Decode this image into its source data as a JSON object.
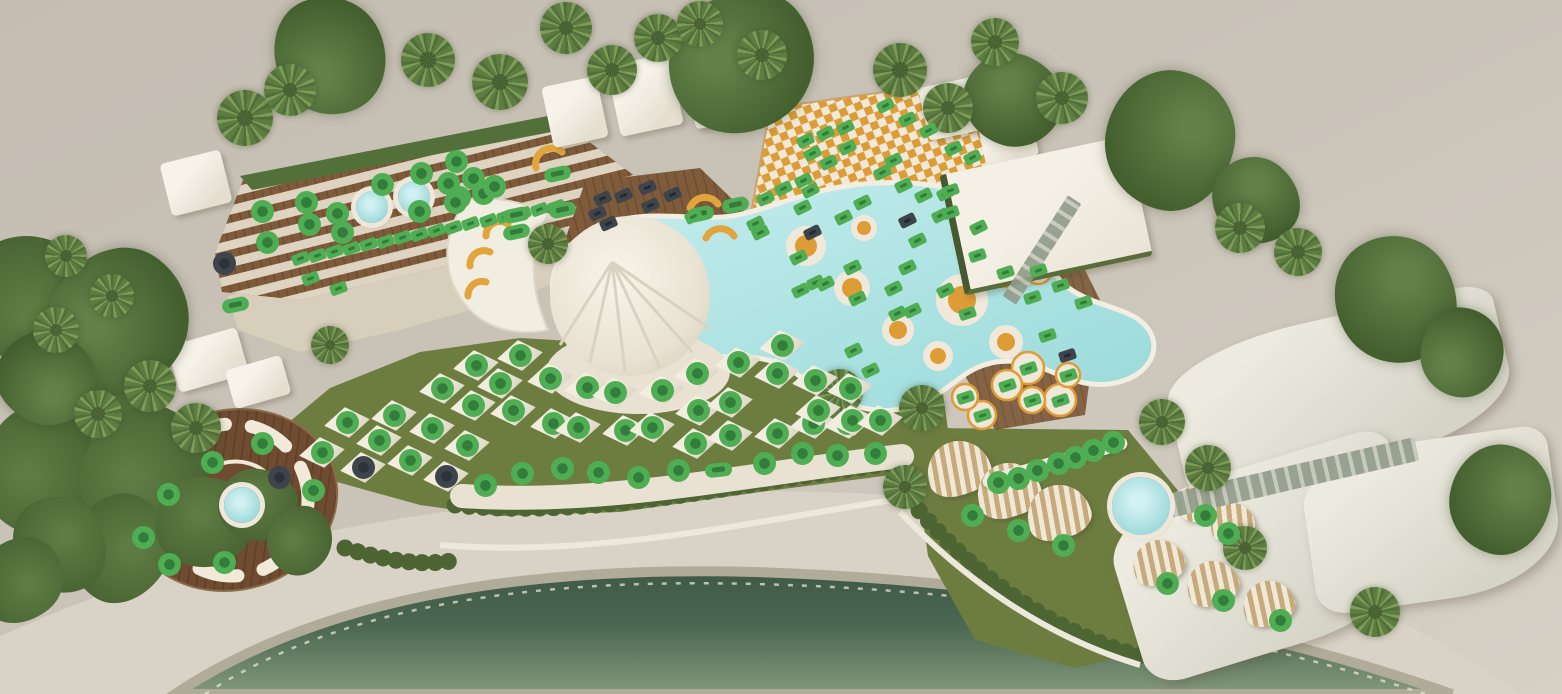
{
  "app": {
    "name": "beach-club-seating-map"
  },
  "colors": {
    "m-avail": "#4fae54",
    "m-avail-inner": "#337c3b",
    "m-occ": "#3d444b",
    "lawn": "#6d7d40",
    "pool": "#aee2e2",
    "sea": "#4c6852",
    "wood": "#7f5b3b",
    "daybed-orange": "#dd9c35",
    "structure": "#f2ede1"
  },
  "legend": {
    "available_marker": "green",
    "occupied_marker": "dark-gray"
  },
  "markers": {
    "groups": [
      {
        "id": "terrace-tables",
        "type": "circle",
        "status": "available",
        "points": [
          [
            267,
            242
          ],
          [
            262,
            211
          ],
          [
            306,
            202
          ],
          [
            337,
            213
          ],
          [
            309,
            224
          ],
          [
            342,
            232
          ],
          [
            382,
            184
          ],
          [
            421,
            173
          ],
          [
            419,
            211
          ],
          [
            456,
            161
          ],
          [
            473,
            178
          ],
          [
            448,
            183
          ],
          [
            459,
            197
          ],
          [
            483,
            193
          ],
          [
            455,
            202
          ],
          [
            494,
            186
          ]
        ]
      },
      {
        "id": "terrace-tables-occupied",
        "type": "circle",
        "status": "occupied",
        "points": [
          [
            224,
            263
          ]
        ]
      },
      {
        "id": "terrace-sunbeds",
        "type": "rect",
        "status": "available",
        "rot": -20,
        "points": [
          [
            300,
            258
          ],
          [
            317,
            255
          ],
          [
            334,
            251
          ],
          [
            351,
            248
          ],
          [
            368,
            244
          ],
          [
            385,
            241
          ],
          [
            402,
            237
          ],
          [
            419,
            234
          ],
          [
            436,
            230
          ],
          [
            453,
            227
          ],
          [
            470,
            223
          ],
          [
            488,
            220
          ],
          [
            505,
            216
          ],
          [
            522,
            213
          ],
          [
            539,
            209
          ],
          [
            556,
            206
          ],
          [
            310,
            278
          ],
          [
            338,
            288
          ]
        ]
      },
      {
        "id": "lounger-pills",
        "type": "pill",
        "status": "available",
        "rot": -12,
        "points": [
          [
            235,
            305
          ],
          [
            557,
            174
          ],
          [
            562,
            210
          ],
          [
            516,
            215
          ],
          [
            516,
            232
          ],
          [
            700,
            214
          ],
          [
            735,
            205
          ]
        ]
      },
      {
        "id": "dining-tables-occupied",
        "type": "rect",
        "status": "occupied",
        "rot": -24,
        "points": [
          [
            597,
            213
          ],
          [
            602,
            198
          ],
          [
            623,
            195
          ],
          [
            647,
            187
          ],
          [
            650,
            205
          ],
          [
            672,
            194
          ],
          [
            608,
            223
          ]
        ]
      },
      {
        "id": "pool-daybeds",
        "type": "rect",
        "status": "available",
        "rot": -26,
        "points": [
          [
            765,
            198
          ],
          [
            783,
            188
          ],
          [
            803,
            180
          ],
          [
            805,
            140
          ],
          [
            812,
            153
          ],
          [
            825,
            133
          ],
          [
            828,
            162
          ],
          [
            845,
            127
          ],
          [
            847,
            147
          ],
          [
            882,
            172
          ],
          [
            885,
            105
          ],
          [
            907,
            119
          ],
          [
            928,
            130
          ],
          [
            953,
            148
          ],
          [
            972,
            157
          ],
          [
            893,
            160
          ],
          [
            755,
            223
          ],
          [
            798,
            257
          ],
          [
            802,
            207
          ],
          [
            815,
            282
          ],
          [
            825,
            283
          ],
          [
            843,
            217
          ],
          [
            857,
            298
          ],
          [
            800,
            290
          ],
          [
            693,
            216
          ],
          [
            760,
            232
          ],
          [
            810,
            190
          ],
          [
            862,
            202
          ],
          [
            852,
            267
          ],
          [
            893,
            288
          ],
          [
            897,
            313
          ],
          [
            912,
            310
          ],
          [
            853,
            350
          ],
          [
            870,
            370
          ],
          [
            923,
            195
          ],
          [
            945,
            193
          ],
          [
            940,
            215
          ],
          [
            917,
            240
          ],
          [
            907,
            267
          ],
          [
            945,
            290
          ],
          [
            978,
            227
          ],
          [
            903,
            185
          ]
        ]
      },
      {
        "id": "pool-daybeds-occupied",
        "type": "rect",
        "status": "occupied",
        "rot": -26,
        "points": [
          [
            812,
            232
          ],
          [
            907,
            220
          ]
        ]
      },
      {
        "id": "lawn-parasols",
        "type": "circle",
        "status": "available",
        "parasol": true,
        "points": [
          [
            322,
            452
          ],
          [
            347,
            422
          ],
          [
            379,
            440
          ],
          [
            394,
            415
          ],
          [
            410,
            460
          ],
          [
            432,
            428
          ],
          [
            442,
            388
          ],
          [
            467,
            445
          ],
          [
            473,
            405
          ],
          [
            476,
            365
          ],
          [
            500,
            383
          ],
          [
            513,
            410
          ],
          [
            520,
            355
          ],
          [
            550,
            378
          ],
          [
            553,
            423
          ],
          [
            578,
            427
          ],
          [
            587,
            387
          ],
          [
            615,
            392
          ],
          [
            625,
            430
          ],
          [
            652,
            427
          ],
          [
            662,
            390
          ],
          [
            695,
            443
          ],
          [
            697,
            373
          ],
          [
            698,
            410
          ],
          [
            730,
            435
          ],
          [
            730,
            402
          ],
          [
            738,
            362
          ],
          [
            777,
            433
          ],
          [
            777,
            373
          ],
          [
            782,
            345
          ],
          [
            813,
            423
          ],
          [
            815,
            380
          ],
          [
            818,
            410
          ],
          [
            847,
            423
          ],
          [
            850,
            388
          ],
          [
            852,
            420
          ],
          [
            880,
            420
          ]
        ]
      },
      {
        "id": "lawn-parasols-occupied",
        "type": "circle",
        "status": "occupied",
        "parasol": true,
        "points": [
          [
            363,
            467
          ],
          [
            446,
            476
          ]
        ]
      },
      {
        "id": "front-row-sunbeds",
        "type": "circle",
        "status": "available",
        "points": [
          [
            485,
            485
          ],
          [
            522,
            473
          ],
          [
            562,
            468
          ],
          [
            598,
            472
          ],
          [
            638,
            477
          ],
          [
            678,
            470
          ],
          [
            764,
            463
          ],
          [
            802,
            453
          ],
          [
            837,
            455
          ],
          [
            875,
            453
          ]
        ]
      },
      {
        "id": "front-row-pill",
        "type": "pill",
        "status": "available",
        "rot": -6,
        "points": [
          [
            718,
            470
          ]
        ]
      },
      {
        "id": "restaurant-tables",
        "type": "rect",
        "status": "available",
        "rot": -18,
        "points": [
          [
            950,
            190
          ],
          [
            950,
            212
          ],
          [
            977,
            255
          ],
          [
            1005,
            272
          ],
          [
            1038,
            270
          ],
          [
            1060,
            285
          ],
          [
            1032,
            297
          ],
          [
            1083,
            302
          ],
          [
            967,
            313
          ],
          [
            1047,
            335
          ],
          [
            1068,
            375
          ],
          [
            1028,
            368
          ],
          [
            1007,
            385
          ],
          [
            1060,
            400
          ],
          [
            1032,
            400
          ],
          [
            982,
            415
          ],
          [
            965,
            397
          ]
        ]
      },
      {
        "id": "restaurant-tables-occupied",
        "type": "rect",
        "status": "occupied",
        "rot": -18,
        "points": [
          [
            1067,
            355
          ]
        ]
      },
      {
        "id": "bar-counter-seats",
        "type": "circle",
        "status": "available",
        "points": [
          [
            998,
            482
          ],
          [
            1018,
            478
          ],
          [
            1037,
            470
          ],
          [
            1058,
            463
          ],
          [
            1075,
            457
          ],
          [
            1093,
            450
          ],
          [
            1113,
            442
          ]
        ]
      },
      {
        "id": "cabana-seats",
        "type": "circle",
        "status": "available",
        "points": [
          [
            972,
            515
          ],
          [
            1018,
            530
          ],
          [
            1063,
            545
          ],
          [
            1205,
            515
          ],
          [
            1228,
            533
          ],
          [
            1167,
            583
          ],
          [
            1223,
            600
          ],
          [
            1280,
            620
          ]
        ]
      },
      {
        "id": "vip-deck-sofas",
        "type": "circle",
        "status": "available",
        "points": [
          [
            262,
            443
          ],
          [
            212,
            462
          ],
          [
            168,
            494
          ],
          [
            143,
            537
          ],
          [
            169,
            564
          ],
          [
            224,
            562
          ],
          [
            313,
            490
          ]
        ]
      },
      {
        "id": "vip-deck-sofas-occupied",
        "type": "circle",
        "status": "occupied",
        "points": [
          [
            279,
            477
          ]
        ]
      }
    ]
  },
  "scene": {
    "tents": [
      [
        196,
        183,
        62,
        54,
        -14
      ],
      [
        152,
        342,
        66,
        44,
        -16
      ],
      [
        208,
        360,
        72,
        48,
        -16
      ],
      [
        258,
        382,
        58,
        40,
        -16
      ],
      [
        575,
        112,
        56,
        62,
        -12
      ],
      [
        645,
        95,
        64,
        72,
        -12
      ],
      [
        723,
        82,
        72,
        82,
        -12
      ],
      [
        955,
        108,
        64,
        54,
        -12
      ],
      [
        1008,
        138,
        54,
        46,
        -12
      ]
    ],
    "sails": [
      [
        1340,
        392,
        340,
        150,
        -13
      ],
      [
        1268,
        556,
        300,
        185,
        -17
      ],
      [
        1432,
        520,
        250,
        160,
        -8
      ]
    ],
    "cabanas": [
      [
        958,
        468,
        64,
        54,
        -18
      ],
      [
        1008,
        490,
        64,
        54,
        -18
      ],
      [
        1058,
        512,
        64,
        54,
        -18
      ],
      [
        1200,
        502,
        44,
        38,
        -14
      ],
      [
        1232,
        522,
        44,
        38,
        -14
      ],
      [
        1158,
        562,
        52,
        44,
        -20
      ],
      [
        1212,
        583,
        52,
        44,
        -20
      ],
      [
        1268,
        603,
        52,
        44,
        -20
      ]
    ],
    "jacuzzis": [
      [
        372,
        207,
        32
      ],
      [
        414,
        197,
        32
      ],
      [
        1141,
        506,
        58
      ],
      [
        242,
        505,
        36
      ]
    ],
    "palms": [
      [
        245,
        118,
        56
      ],
      [
        290,
        90,
        52
      ],
      [
        428,
        60,
        54
      ],
      [
        500,
        82,
        56
      ],
      [
        566,
        28,
        52
      ],
      [
        612,
        70,
        50
      ],
      [
        658,
        38,
        48
      ],
      [
        700,
        24,
        46
      ],
      [
        762,
        55,
        50
      ],
      [
        900,
        70,
        54
      ],
      [
        948,
        108,
        50
      ],
      [
        995,
        42,
        48
      ],
      [
        1062,
        98,
        52
      ],
      [
        548,
        244,
        40
      ],
      [
        1240,
        228,
        50
      ],
      [
        1298,
        252,
        48
      ],
      [
        150,
        386,
        52
      ],
      [
        196,
        428,
        50
      ],
      [
        98,
        414,
        48
      ],
      [
        56,
        330,
        46
      ],
      [
        112,
        296,
        44
      ],
      [
        66,
        256,
        42
      ],
      [
        840,
        392,
        46
      ],
      [
        922,
        408,
        46
      ],
      [
        905,
        487,
        44
      ],
      [
        1162,
        422,
        46
      ],
      [
        1208,
        468,
        46
      ],
      [
        1245,
        548,
        44
      ],
      [
        1375,
        612,
        50
      ],
      [
        330,
        345,
        38
      ]
    ],
    "canopies": [
      [
        330,
        55,
        120
      ],
      [
        742,
        62,
        150
      ],
      [
        1013,
        100,
        100
      ],
      [
        1170,
        140,
        140
      ],
      [
        1256,
        200,
        90
      ],
      [
        1396,
        300,
        130
      ],
      [
        1462,
        352,
        90
      ],
      [
        118,
        322,
        150
      ],
      [
        46,
        378,
        100
      ],
      [
        1500,
        500,
        110
      ]
    ],
    "foliage": [
      [
        30,
        300,
        140
      ],
      [
        85,
        385,
        150
      ],
      [
        40,
        470,
        130
      ],
      [
        145,
        475,
        140
      ],
      [
        120,
        548,
        110
      ],
      [
        205,
        522,
        100
      ],
      [
        60,
        545,
        100
      ],
      [
        258,
        505,
        80
      ],
      [
        300,
        540,
        70
      ],
      [
        20,
        580,
        90
      ]
    ],
    "counters": [
      [
        1055,
        462,
        150,
        13,
        -16
      ]
    ],
    "glass_walls": [
      [
        1290,
        478,
        260,
        24,
        -13
      ],
      [
        1042,
        250,
        120,
        16,
        -57
      ]
    ],
    "buildings": [
      [
        1042,
        213,
        185,
        118,
        -12
      ]
    ]
  }
}
